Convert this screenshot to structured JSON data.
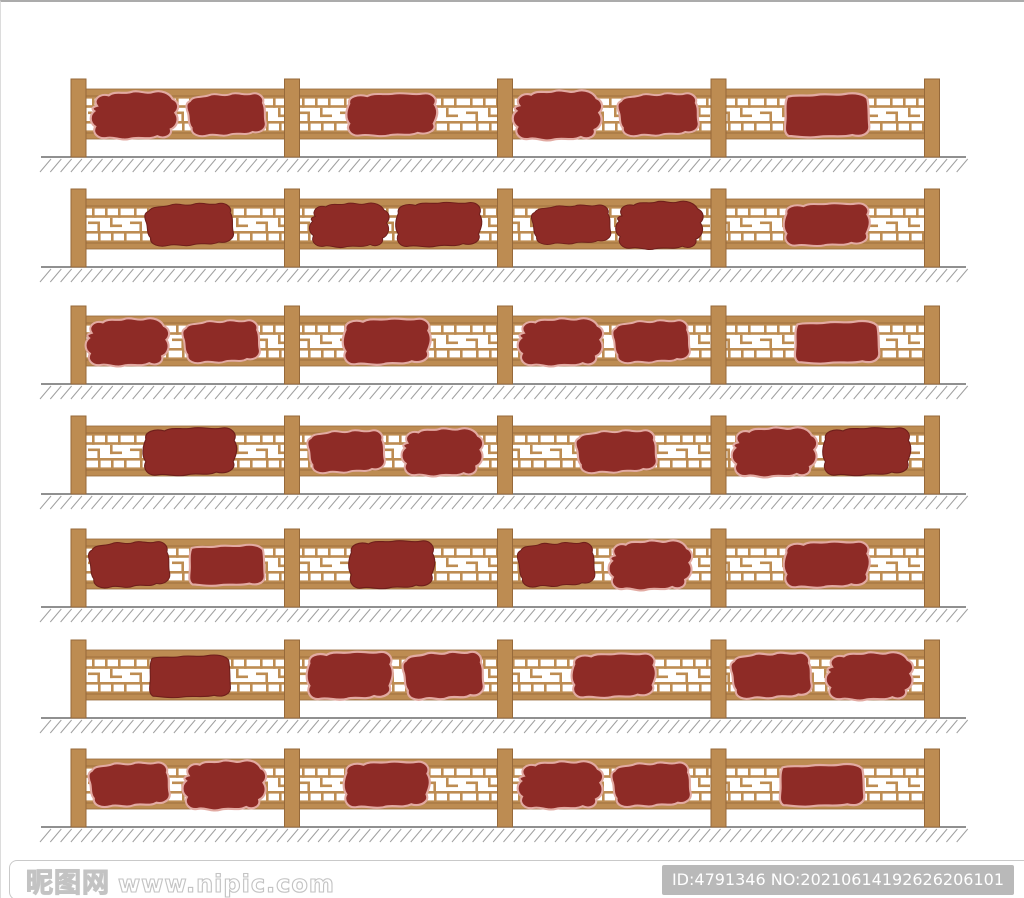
{
  "image": {
    "background": "#ffffff",
    "border_top_color": "#ababab",
    "description_semantic": "seven-elevation-views-of-chinese-wood-lattice-railing-with-red-plaques"
  },
  "colors": {
    "wood": "#bd8c52",
    "wood_stroke": "#96693a",
    "plaque": "#8e2b26",
    "plaque_outline_light": "#e2aaa2",
    "plaque_outline_dark": "#6f1f1b",
    "ground_line": "#6b6b6b",
    "hatch": "#a0a0a0",
    "watermark_outline": "#c3c3c3",
    "id_badge_bg": "#b9b9b9",
    "id_badge_text": "#ffffff"
  },
  "fence_rows": [
    {
      "top": 67,
      "plaques": [
        {
          "cx": 132,
          "w": 90,
          "h": 52,
          "variant": 1,
          "outline": true
        },
        {
          "cx": 225,
          "w": 86,
          "h": 50,
          "variant": 2,
          "outline": true
        },
        {
          "cx": 390,
          "w": 95,
          "h": 50,
          "variant": 3,
          "outline": true
        },
        {
          "cx": 555,
          "w": 92,
          "h": 54,
          "variant": 1,
          "outline": true
        },
        {
          "cx": 657,
          "w": 88,
          "h": 50,
          "variant": 2,
          "outline": true
        },
        {
          "cx": 825,
          "w": 94,
          "h": 56,
          "variant": 4,
          "outline": true
        }
      ]
    },
    {
      "top": 177,
      "plaques": [
        {
          "cx": 188,
          "w": 96,
          "h": 50,
          "variant": 2,
          "outline": false
        },
        {
          "cx": 347,
          "w": 82,
          "h": 48,
          "variant": 1,
          "outline": false
        },
        {
          "cx": 437,
          "w": 90,
          "h": 52,
          "variant": 3,
          "outline": false
        },
        {
          "cx": 570,
          "w": 86,
          "h": 46,
          "variant": 2,
          "outline": false
        },
        {
          "cx": 657,
          "w": 90,
          "h": 52,
          "variant": 1,
          "outline": false
        },
        {
          "cx": 825,
          "w": 90,
          "h": 50,
          "variant": 3,
          "outline": true
        }
      ]
    },
    {
      "top": 294,
      "plaques": [
        {
          "cx": 125,
          "w": 86,
          "h": 52,
          "variant": 1,
          "outline": true
        },
        {
          "cx": 220,
          "w": 84,
          "h": 50,
          "variant": 2,
          "outline": true
        },
        {
          "cx": 385,
          "w": 92,
          "h": 54,
          "variant": 3,
          "outline": true
        },
        {
          "cx": 558,
          "w": 88,
          "h": 52,
          "variant": 1,
          "outline": true
        },
        {
          "cx": 650,
          "w": 84,
          "h": 50,
          "variant": 2,
          "outline": true
        },
        {
          "cx": 835,
          "w": 94,
          "h": 54,
          "variant": 4,
          "outline": true
        }
      ]
    },
    {
      "top": 404,
      "plaques": [
        {
          "cx": 188,
          "w": 98,
          "h": 56,
          "variant": 3,
          "outline": false
        },
        {
          "cx": 345,
          "w": 84,
          "h": 50,
          "variant": 2,
          "outline": true
        },
        {
          "cx": 440,
          "w": 84,
          "h": 52,
          "variant": 1,
          "outline": true
        },
        {
          "cx": 615,
          "w": 88,
          "h": 50,
          "variant": 2,
          "outline": true
        },
        {
          "cx": 772,
          "w": 88,
          "h": 54,
          "variant": 1,
          "outline": true
        },
        {
          "cx": 865,
          "w": 92,
          "h": 56,
          "variant": 3,
          "outline": false
        }
      ]
    },
    {
      "top": 517,
      "plaques": [
        {
          "cx": 128,
          "w": 88,
          "h": 54,
          "variant": 2,
          "outline": false
        },
        {
          "cx": 225,
          "w": 84,
          "h": 52,
          "variant": 4,
          "outline": true
        },
        {
          "cx": 390,
          "w": 90,
          "h": 56,
          "variant": 3,
          "outline": false
        },
        {
          "cx": 555,
          "w": 84,
          "h": 52,
          "variant": 2,
          "outline": false
        },
        {
          "cx": 648,
          "w": 86,
          "h": 54,
          "variant": 1,
          "outline": true
        },
        {
          "cx": 825,
          "w": 90,
          "h": 54,
          "variant": 3,
          "outline": true
        }
      ]
    },
    {
      "top": 628,
      "plaques": [
        {
          "cx": 188,
          "w": 90,
          "h": 54,
          "variant": 4,
          "outline": false
        },
        {
          "cx": 348,
          "w": 90,
          "h": 56,
          "variant": 3,
          "outline": true
        },
        {
          "cx": 442,
          "w": 88,
          "h": 56,
          "variant": 2,
          "outline": true
        },
        {
          "cx": 612,
          "w": 88,
          "h": 52,
          "variant": 3,
          "outline": true
        },
        {
          "cx": 770,
          "w": 88,
          "h": 54,
          "variant": 2,
          "outline": true
        },
        {
          "cx": 867,
          "w": 90,
          "h": 52,
          "variant": 1,
          "outline": true
        }
      ]
    },
    {
      "top": 737,
      "plaques": [
        {
          "cx": 128,
          "w": 88,
          "h": 52,
          "variant": 2,
          "outline": true
        },
        {
          "cx": 222,
          "w": 86,
          "h": 54,
          "variant": 1,
          "outline": true
        },
        {
          "cx": 385,
          "w": 90,
          "h": 54,
          "variant": 3,
          "outline": true
        },
        {
          "cx": 558,
          "w": 88,
          "h": 52,
          "variant": 1,
          "outline": true
        },
        {
          "cx": 650,
          "w": 86,
          "h": 52,
          "variant": 2,
          "outline": true
        },
        {
          "cx": 820,
          "w": 94,
          "h": 54,
          "variant": 4,
          "outline": true
        }
      ]
    }
  ],
  "footer": {
    "site_name": "昵图网",
    "site_url": "www.nipic.com",
    "id_text": "ID:4791346 NO:20210614192626206101"
  }
}
